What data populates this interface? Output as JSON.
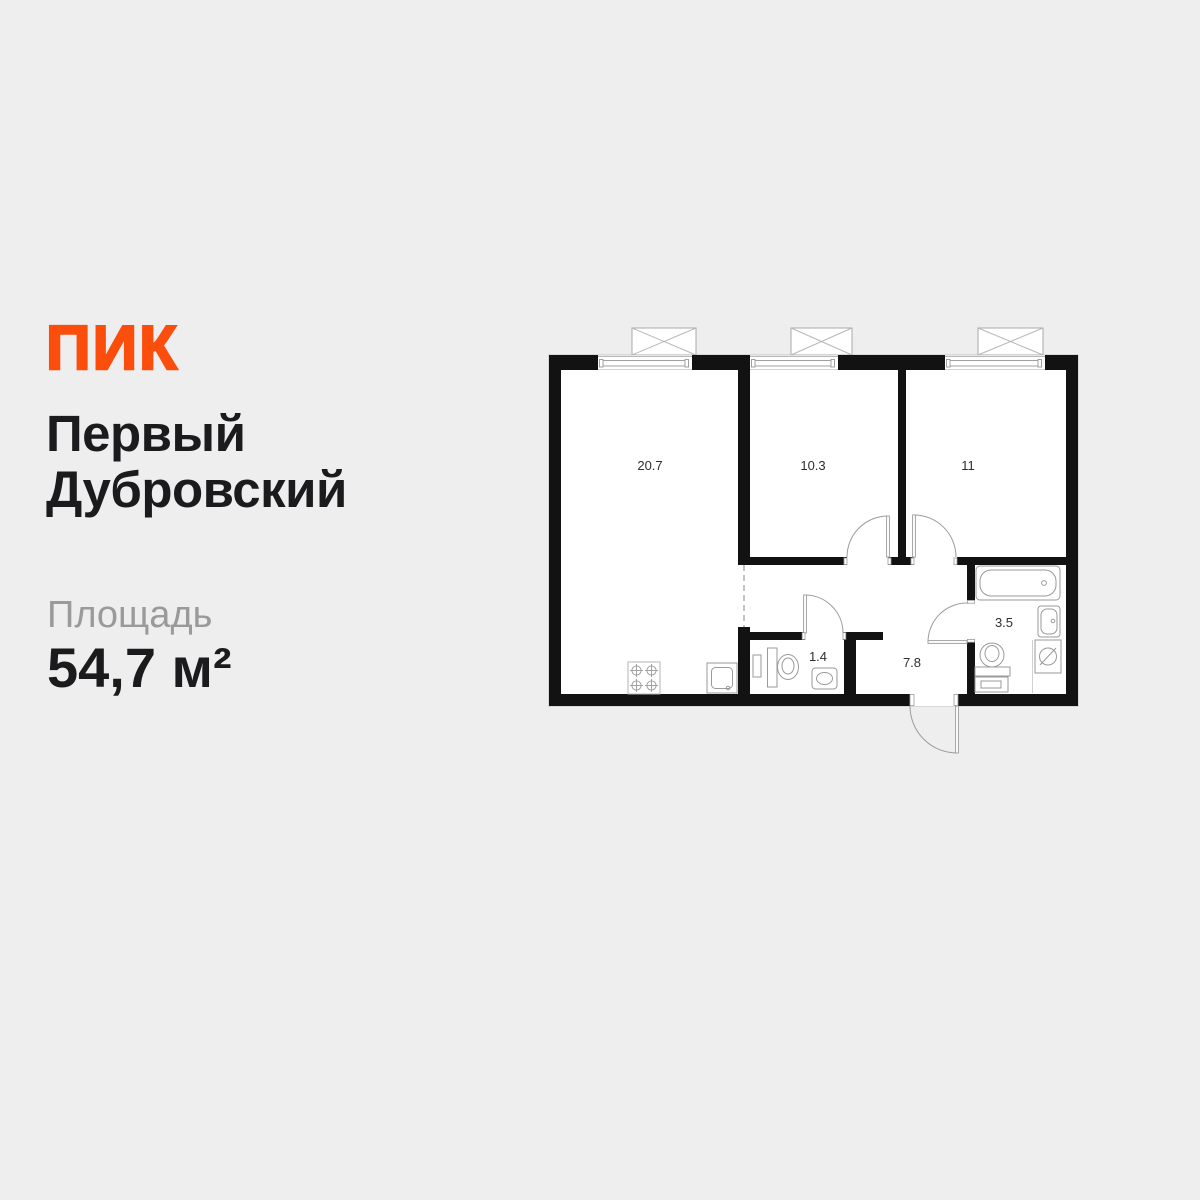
{
  "page": {
    "background": "#EEEEEE"
  },
  "brand": {
    "logo_text": "ПИК",
    "logo_color": "#FB4E0D"
  },
  "title": {
    "line1": "Первый",
    "line2": "Дубровский"
  },
  "area": {
    "label": "Площадь",
    "value": "54,7 м²"
  },
  "floorplan": {
    "wall_color": "#121212",
    "floor_color": "#FFFFFF",
    "line_color": "#9B9B9B",
    "rooms": [
      {
        "name": "living-kitchen",
        "area_label": "20.7"
      },
      {
        "name": "bedroom-1",
        "area_label": "10.3"
      },
      {
        "name": "bedroom-2",
        "area_label": "11"
      },
      {
        "name": "toilet",
        "area_label": "1.4"
      },
      {
        "name": "hallway",
        "area_label": "7.8"
      },
      {
        "name": "bathroom",
        "area_label": "3.5"
      }
    ],
    "fixtures": [
      "stove-icon",
      "kitchen-sink-icon",
      "toilet-icon",
      "toilet-sink-icon",
      "bathtub-icon",
      "bathroom-sink-icon",
      "washing-machine-icon",
      "window-icon",
      "balcony-box-icon",
      "door-arc-icon",
      "entrance-door-icon"
    ]
  }
}
